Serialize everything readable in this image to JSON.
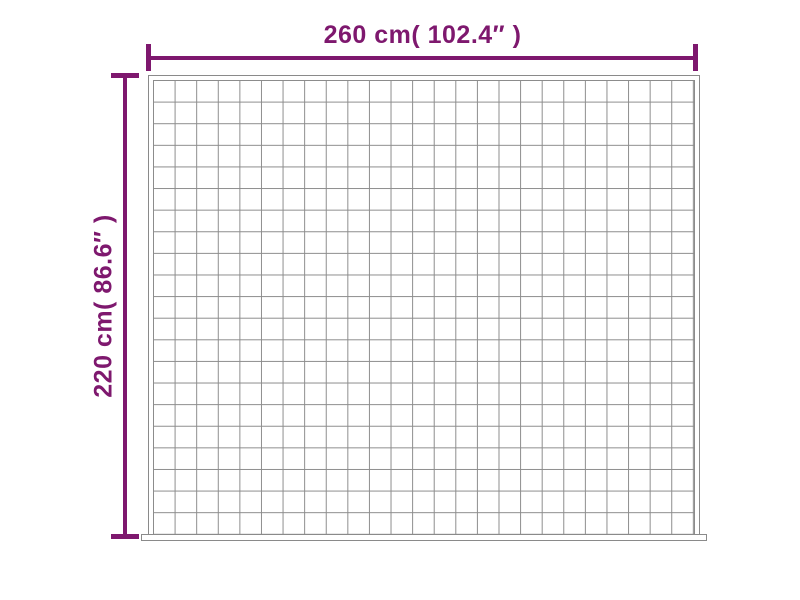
{
  "diagram": {
    "type": "product-dimension-diagram",
    "subject": "quilted weighted blanket grid",
    "width_label": "260 cm( 102.4″ )",
    "height_label": "220 cm( 86.6″ )",
    "grid": {
      "columns": 25,
      "rows": 21
    },
    "colors": {
      "accent": "#7E186E",
      "grid_line": "#8C8C8C",
      "edge_line": "#8A8A8A",
      "background": "#FFFFFF"
    }
  }
}
